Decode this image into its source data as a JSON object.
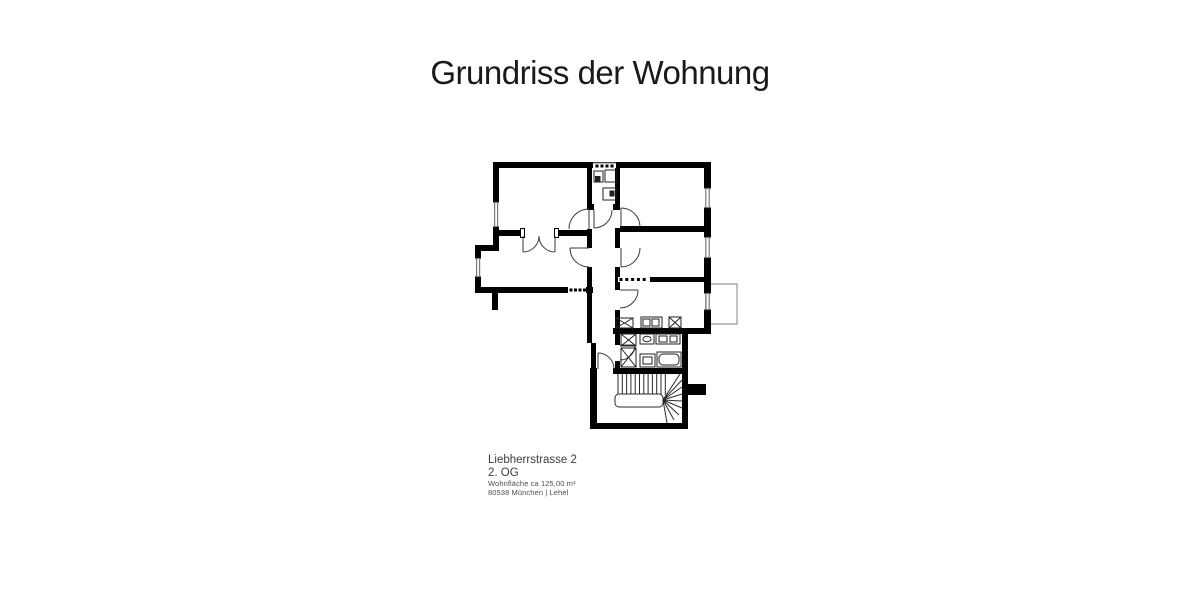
{
  "title": "Grundriss der Wohnung",
  "address": {
    "street": "Liebherrstrasse 2",
    "floor": "2. OG",
    "area": "Wohnfläche ca 125,00 m²",
    "city": "80538 München | Lehel"
  },
  "floorplan": {
    "wall_color": "#000000",
    "door_line_color": "#3a3a3a",
    "fixture_line_color": "#222222",
    "window_line_color": "#7a7a7a",
    "balcony_line_color": "#9a9a9a",
    "background": "#ffffff"
  }
}
